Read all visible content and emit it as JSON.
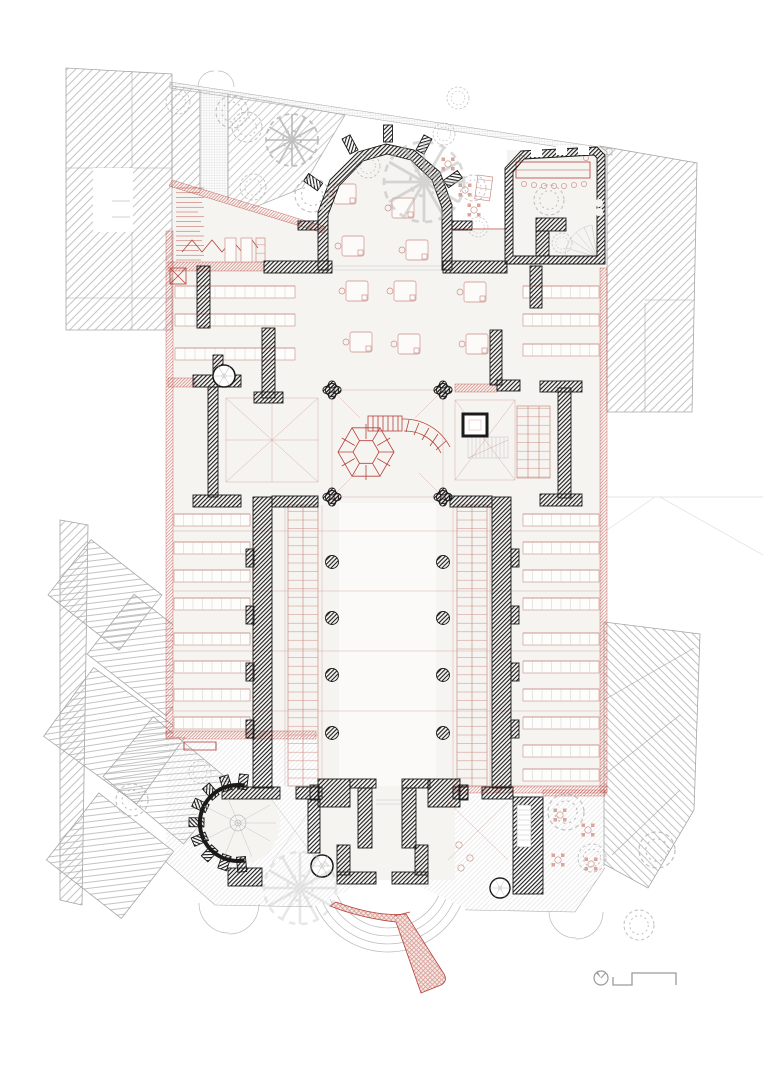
{
  "canvas": {
    "width": 763,
    "height": 1080,
    "background": "#ffffff"
  },
  "palette": {
    "background": "#ffffff",
    "wall_black": "#1a1a1a",
    "annotation_red": "#b6423a",
    "annotation_red_light": "#c98c84",
    "context_gray": "#a6a6a6",
    "paving_gray": "#d4d4d4",
    "tree_gray": "#b3b3b3",
    "symbol_gray": "#9a9a9a",
    "interior_fill": "#f6f4f1",
    "ramp_fill": "#f8e9e6"
  },
  "annotations": {
    "north_arrow": {
      "icon": "north-arrow-icon",
      "label": "north arrow"
    },
    "scale_bar": {
      "icon": "scale-bar-icon",
      "label": "graphic scale bar"
    },
    "legend_text_block": {
      "label": "illegible small red schedule text"
    }
  },
  "plan_elements": {
    "building": "church floor plan with red furnishing annotations",
    "context": "surrounding urban block roofs, gray hatch",
    "garden": "trees and paved courtyards",
    "entrance": "curved steps with red hatched access ramp"
  }
}
